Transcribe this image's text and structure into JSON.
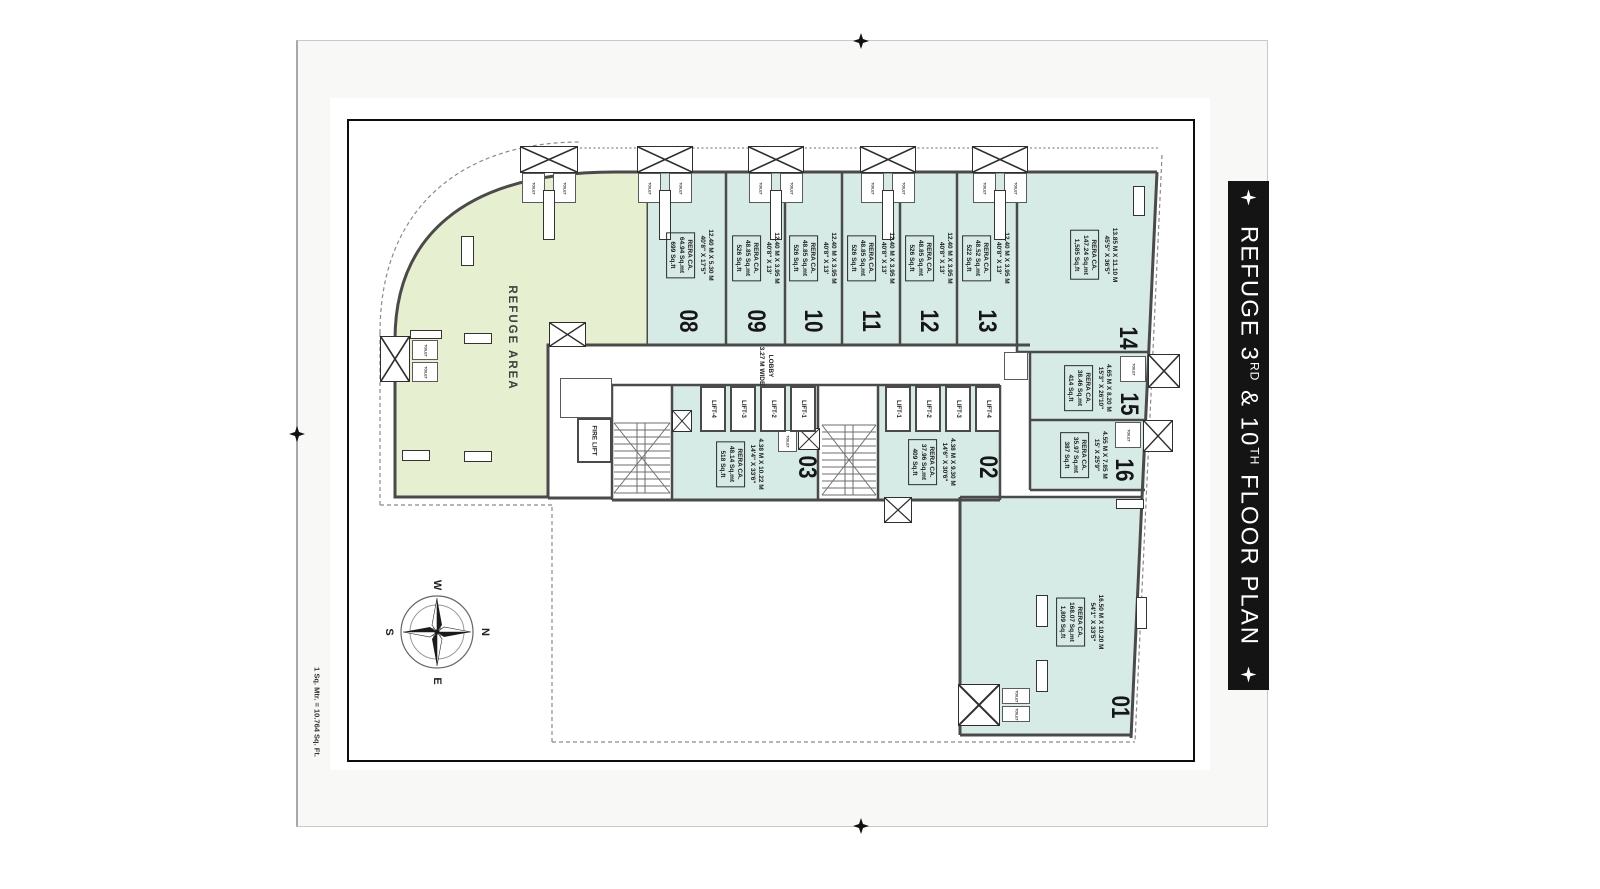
{
  "banner": {
    "part1": "REFUGE 3",
    "sup1": "RD",
    "part2": " & 10",
    "sup2": "TH",
    "part3": " FLOOR PLAN"
  },
  "plan": {
    "refuge_area_label": "REFUGE AREA",
    "lobby_line1": "LOBBY",
    "lobby_line2": "3.27 M WIDE",
    "fire_lift_label": "FIRE LIFT",
    "toilet_label": "TOILET",
    "scale_note": "1 Sq. Mtr. = 10.764 Sq. Ft."
  },
  "compass": {
    "west": "W",
    "north": "N",
    "east": "E",
    "south": "S"
  },
  "rera_label": "RERA CA.",
  "lifts_left": [
    "LIFT-4",
    "LIFT-3",
    "LIFT-2",
    "LIFT-1"
  ],
  "lifts_right": [
    "LIFT-1",
    "LIFT-2",
    "LIFT-3",
    "LIFT-4"
  ],
  "units": {
    "u01": {
      "number": "01",
      "dim_m": "16.50 M X 10.20 M",
      "dim_ft": "54'1\" X 33'5\"",
      "sqmt": "168.07 Sq.mt",
      "sqft": "1,809 Sq.ft"
    },
    "u02": {
      "number": "02",
      "dim_m": "4.38 M X 9.30 M",
      "dim_ft": "14'6\" X 30'6\"",
      "sqmt": "37.96 Sq.mt",
      "sqft": "409 Sq.ft"
    },
    "u03": {
      "number": "03",
      "dim_m": "4.38 M X 10.22 M",
      "dim_ft": "14'4\" X 33'6\"",
      "sqmt": "48.14 Sq.mt",
      "sqft": "518 Sq.ft"
    },
    "u08": {
      "number": "08",
      "dim_m": "12.40 M X 5.30 M",
      "dim_ft": "40'8\" X 17'5\"",
      "sqmt": "64.94 Sq.mt",
      "sqft": "699 Sq.ft"
    },
    "u09": {
      "number": "09",
      "dim_m": "12.40 M X 3.95 M",
      "dim_ft": "40'8\" X 13'",
      "sqmt": "48.85 Sq.mt",
      "sqft": "526 Sq.ft"
    },
    "u10": {
      "number": "10",
      "dim_m": "12.40 M X 3.95 M",
      "dim_ft": "40'8\" X 13'",
      "sqmt": "48.85 Sq.mt",
      "sqft": "526 Sq.ft"
    },
    "u11": {
      "number": "11",
      "dim_m": "12.40 M X 3.95 M",
      "dim_ft": "40'8\" X 13'",
      "sqmt": "48.85 Sq.mt",
      "sqft": "526 Sq.ft"
    },
    "u12": {
      "number": "12",
      "dim_m": "12.40 M X 3.95 M",
      "dim_ft": "40'8\" X 13'",
      "sqmt": "48.85 Sq.mt",
      "sqft": "526 Sq.ft"
    },
    "u13": {
      "number": "13",
      "dim_m": "12.40 M X 3.95 M",
      "dim_ft": "40'8\" X 13'",
      "sqmt": "48.52 Sq.mt",
      "sqft": "522 Sq.ft"
    },
    "u14": {
      "number": "14",
      "dim_m": "13.85 M X 11.10 M",
      "dim_ft": "45'5\" X 36'5\"",
      "sqmt": "147.24 Sq.mt",
      "sqft": "1,585 Sq.ft"
    },
    "u15": {
      "number": "15",
      "dim_m": "4.65 M X 8.20 M",
      "dim_ft": "15'3\" X 26'10\"",
      "sqmt": "38.46 Sq.mt",
      "sqft": "414 Sq.ft"
    },
    "u16": {
      "number": "16",
      "dim_m": "4.55 M X 7.85 M",
      "dim_ft": "15' X 25'9\"",
      "sqmt": "35.97 Sq.mt",
      "sqft": "387 Sq.ft"
    }
  },
  "colors": {
    "unit_fill": "#d6eae6",
    "refuge_fill": "#e6efcf",
    "wall": "#4a4a4a",
    "banner_bg": "#141414"
  }
}
